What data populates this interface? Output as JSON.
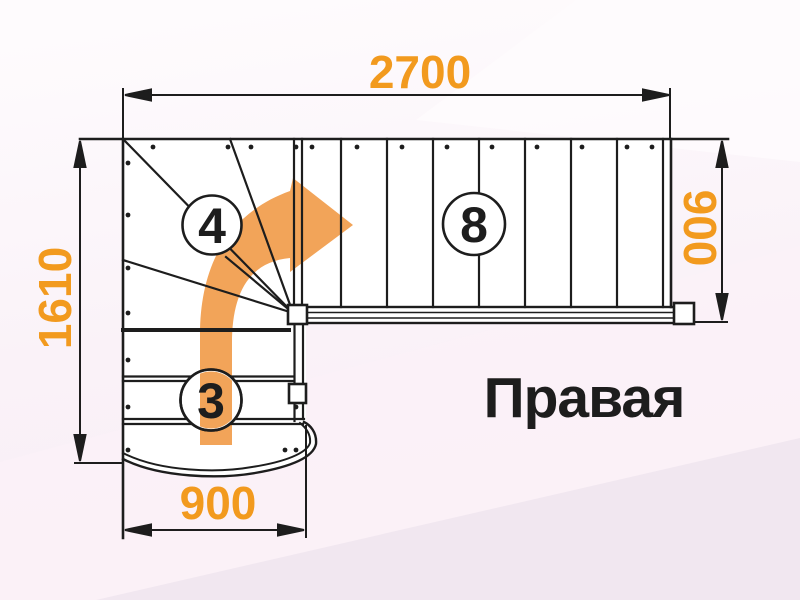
{
  "diagram": {
    "caption": "Правая",
    "dimensions": {
      "top": "2700",
      "left": "1610",
      "right": "900",
      "bottom": "900"
    },
    "step_counts": {
      "winder_flight": "4",
      "upper_flight": "8",
      "lower_flight": "3"
    },
    "colors": {
      "dimension_text": "#F29A1E",
      "direction_arrow": "#F2A459",
      "drawing_line": "#1D1D1D"
    }
  }
}
